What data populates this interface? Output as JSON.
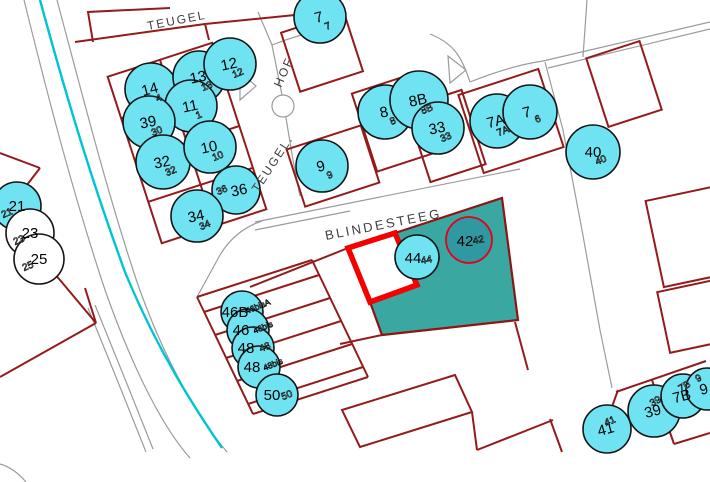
{
  "streets": {
    "teugel_top": "TEUGEL",
    "hof": "HOF",
    "teugel_side": "TEUGEL.",
    "blindesteeg": "BLINDESTEEG"
  },
  "addresses": [
    {
      "label": "7",
      "sub": "7"
    },
    {
      "label": "14",
      "sub": "4"
    },
    {
      "label": "13",
      "sub": "13"
    },
    {
      "label": "12",
      "sub": "12"
    },
    {
      "label": "11",
      "sub": "1"
    },
    {
      "label": "39",
      "sub": "30"
    },
    {
      "label": "32",
      "sub": "32"
    },
    {
      "label": "10",
      "sub": "10"
    },
    {
      "label": "36",
      "sub": "36"
    },
    {
      "label": "34",
      "sub": "34"
    },
    {
      "label": "9",
      "sub": "9"
    },
    {
      "label": "8",
      "sub": "8"
    },
    {
      "label": "8B",
      "sub": "8B"
    },
    {
      "label": "33",
      "sub": "33"
    },
    {
      "label": "7A",
      "sub": "7A"
    },
    {
      "label": "7",
      "sub": "6"
    },
    {
      "label": "40",
      "sub": "40"
    },
    {
      "label": "21",
      "sub": "21"
    },
    {
      "label": "23",
      "sub": "23"
    },
    {
      "label": "25",
      "sub": "25"
    },
    {
      "label": "44",
      "sub": "44"
    },
    {
      "label": "42",
      "sub": "42"
    },
    {
      "label": "46B",
      "sub": "46bisA"
    },
    {
      "label": "46",
      "sub": "46bis"
    },
    {
      "label": "48",
      "sub": "48"
    },
    {
      "label": "48",
      "sub": "48bis"
    },
    {
      "label": "50",
      "sub": "50"
    },
    {
      "label": "41",
      "sub": "41"
    },
    {
      "label": "39",
      "sub": "39"
    },
    {
      "label": "7B",
      "sub": "7B"
    },
    {
      "label": "9",
      "sub": "9"
    }
  ],
  "colors": {
    "address_circle_fill": "#6fe3f2",
    "address_circle_outline": "#141414",
    "vacant_circle_fill": "#ffffff",
    "selected_circle_fill": "#2f98a0",
    "selected_circle_outline": "#e50019",
    "parcel_line": "#941b1b",
    "selected_parcel_fill": "#3aa8a1",
    "highlight_outline": "#f40000",
    "water_line": "#00c4d4",
    "road_line": "#9b9b9b",
    "street_label": "#3d3d3d"
  }
}
